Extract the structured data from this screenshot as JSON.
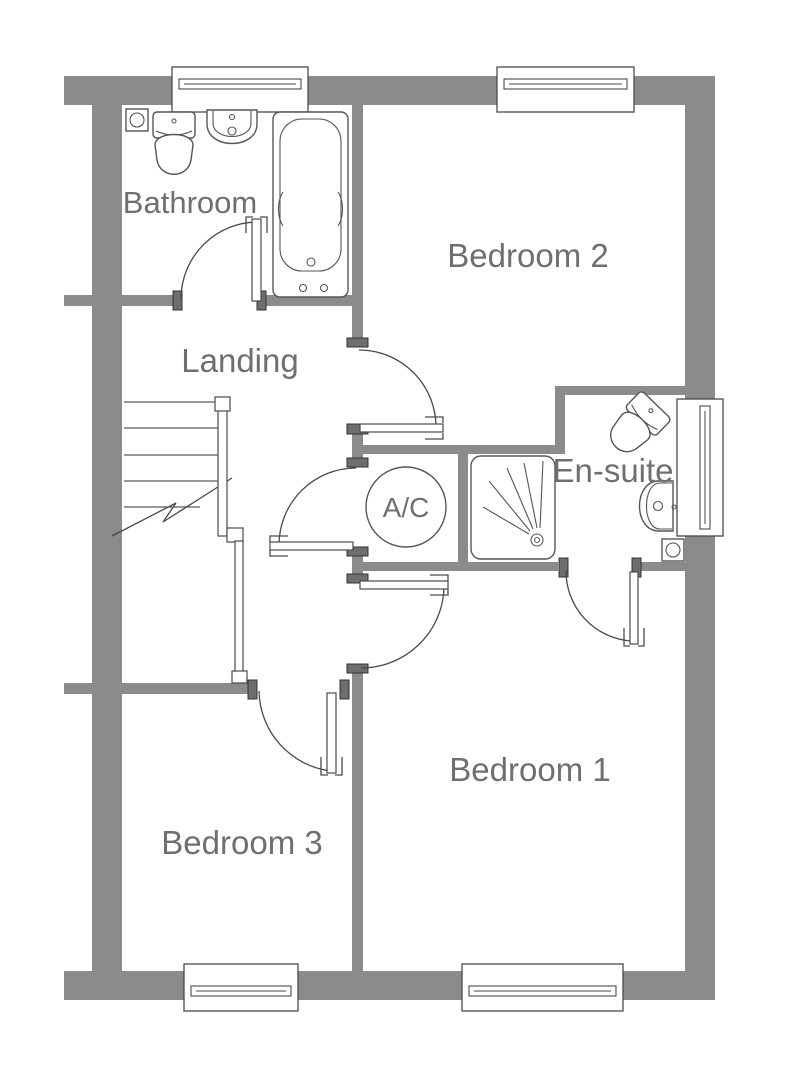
{
  "floor_plan": {
    "rooms": {
      "bathroom": {
        "label": "Bathroom"
      },
      "bedroom2": {
        "label": "Bedroom 2"
      },
      "landing": {
        "label": "Landing"
      },
      "ensuite": {
        "label": "En-suite"
      },
      "airing_cupboard": {
        "label": "A/C"
      },
      "bedroom1": {
        "label": "Bedroom 1"
      },
      "bedroom3": {
        "label": "Bedroom 3"
      }
    },
    "fixtures": {
      "bathroom": [
        "toilet",
        "washbasin",
        "bath",
        "extractor-fan"
      ],
      "ensuite": [
        "toilet",
        "washbasin",
        "shower-tray",
        "extractor-fan"
      ],
      "landing": [
        "staircase",
        "banister",
        "stair-break-line"
      ],
      "window_count": 5,
      "door_count": 6
    },
    "colors": {
      "wall": "#8b8b8b",
      "door_jamb": "#6e6e6e",
      "fixture_outline": "#555555",
      "label_text": "#6f6f6f",
      "background": "#ffffff"
    }
  }
}
